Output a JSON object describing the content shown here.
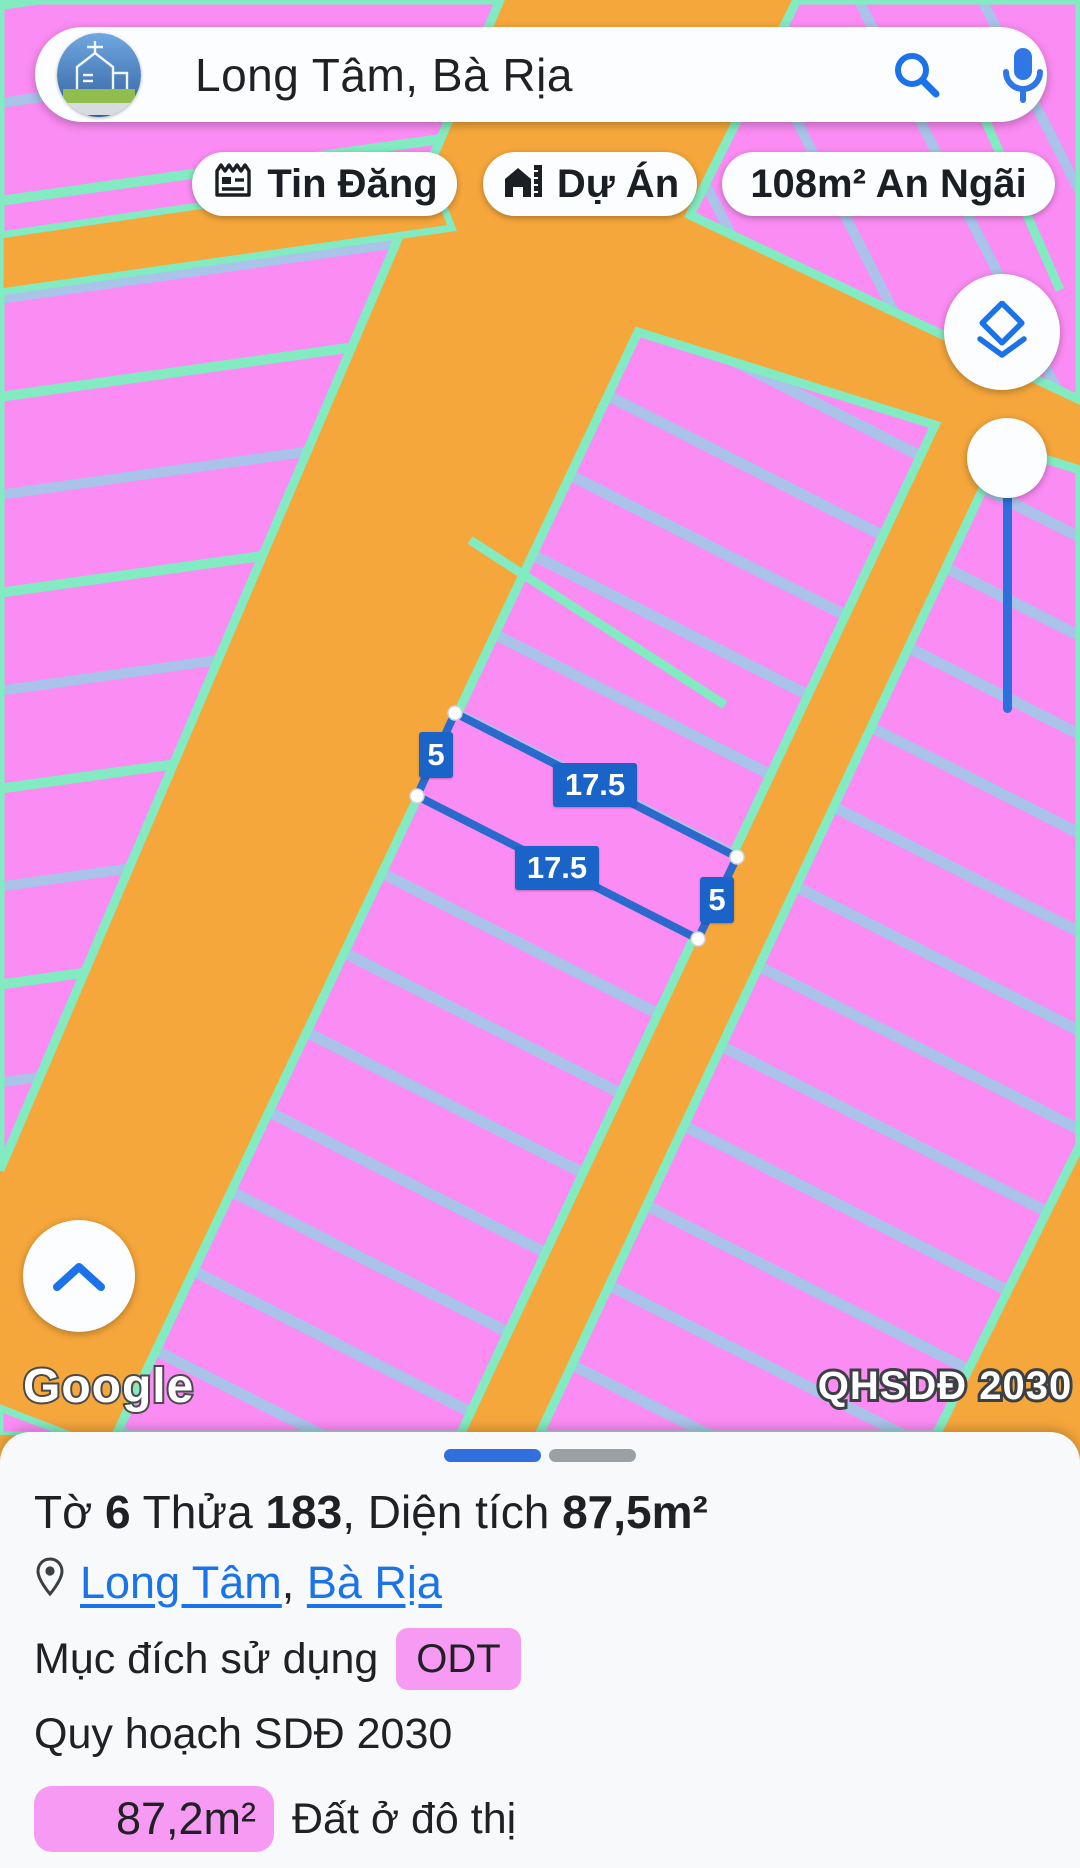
{
  "colors": {
    "map_orange": "#F6A73B",
    "map_pink": "#FB8CF4",
    "boundary_teal": "#83EBC1",
    "lot_line_blue": "#A9C3E9",
    "parcel_stroke_blue": "#2B6ACD",
    "measure_label_blue": "#1A63C9",
    "accent_blue": "#1A73E8",
    "progress_blue": "#2F6FDE",
    "progress_gray": "#9AA0A6",
    "badge_pink": "#F79AF3"
  },
  "search": {
    "query": "Long Tâm, Bà Rịa"
  },
  "chips": {
    "listings": "Tin Đăng",
    "projects": "Dự Án",
    "area": "108m² An Ngãi"
  },
  "map": {
    "measurements": {
      "left_width": "5",
      "top_length": "17.5",
      "bottom_length": "17.5",
      "right_width": "5"
    },
    "watermark": "Google",
    "plan_badge": "QHSDĐ 2030"
  },
  "panel": {
    "title": {
      "t0": "Tờ ",
      "t1": "6",
      "t2": " Thửa ",
      "t3": "183",
      "t4": ", Diện tích ",
      "t5": "87,5m²"
    },
    "location": {
      "link1": "Long Tâm",
      "separator": ", ",
      "link2": "Bà Rịa"
    },
    "purpose": {
      "label": "Mục đích sử dụng",
      "badge": "ODT"
    },
    "plan": "Quy hoạch SDĐ 2030",
    "area": {
      "badge": "87,2m²",
      "label": "Đất ở đô thị"
    }
  }
}
